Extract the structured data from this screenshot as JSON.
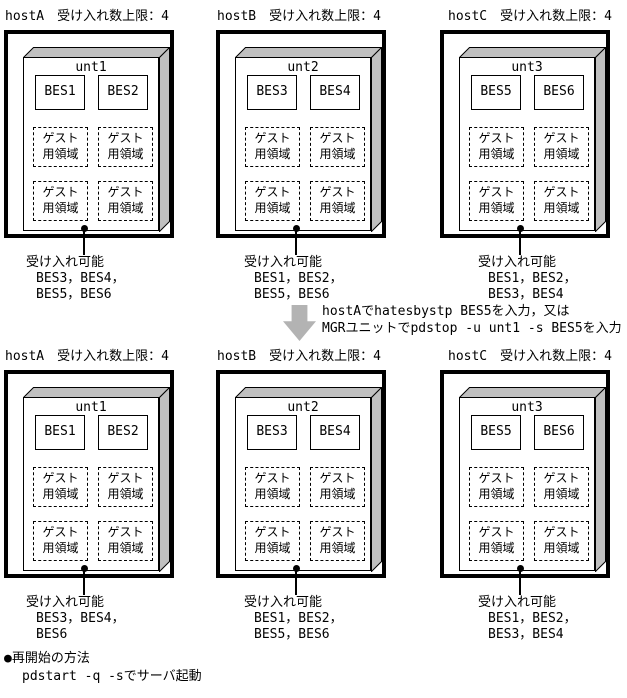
{
  "labels": {
    "guest_line1": "ゲスト",
    "guest_line2": "用領域"
  },
  "hosts": [
    {
      "name": "hostA",
      "limit": "受け入れ数上限：4",
      "unit": "unt1",
      "bes": [
        "BES1",
        "BES2"
      ],
      "accept_title": "受け入れ可能",
      "accept_lines": [
        "BES3，BES4，",
        "BES5，BES6"
      ]
    },
    {
      "name": "hostB",
      "limit": "受け入れ数上限：4",
      "unit": "unt2",
      "bes": [
        "BES3",
        "BES4"
      ],
      "accept_title": "受け入れ可能",
      "accept_lines": [
        "BES1，BES2，",
        "BES5，BES6"
      ]
    },
    {
      "name": "hostC",
      "limit": "受け入れ数上限：4",
      "unit": "unt3",
      "bes": [
        "BES5",
        "BES6"
      ],
      "accept_title": "受け入れ可能",
      "accept_lines": [
        "BES1，BES2，",
        "BES3，BES4"
      ]
    },
    {
      "name": "hostA",
      "limit": "受け入れ数上限：4",
      "unit": "unt1",
      "bes": [
        "BES1",
        "BES2"
      ],
      "accept_title": "受け入れ可能",
      "accept_lines": [
        "BES3，BES4，",
        "BES6"
      ]
    },
    {
      "name": "hostB",
      "limit": "受け入れ数上限：4",
      "unit": "unt2",
      "bes": [
        "BES3",
        "BES4"
      ],
      "accept_title": "受け入れ可能",
      "accept_lines": [
        "BES1，BES2，",
        "BES5，BES6"
      ]
    },
    {
      "name": "hostC",
      "limit": "受け入れ数上限：4",
      "unit": "unt3",
      "bes": [
        "BES5",
        "BES6"
      ],
      "accept_title": "受け入れ可能",
      "accept_lines": [
        "BES1，BES2，",
        "BES3，BES4"
      ]
    }
  ],
  "transition": {
    "line1": "hostAでhatesbystp BES5を入力，又は",
    "line2": "MGRユニットでpdstop -u unt1 -s BES5を入力"
  },
  "footnote": {
    "title": "●再開始の方法",
    "command": "pdstart -q -sでサーバ起動"
  },
  "colors": {
    "shade_gray": "#c0c0c0",
    "arrow_gray": "#b3b3b3",
    "line_black": "#000000",
    "background": "#ffffff"
  }
}
